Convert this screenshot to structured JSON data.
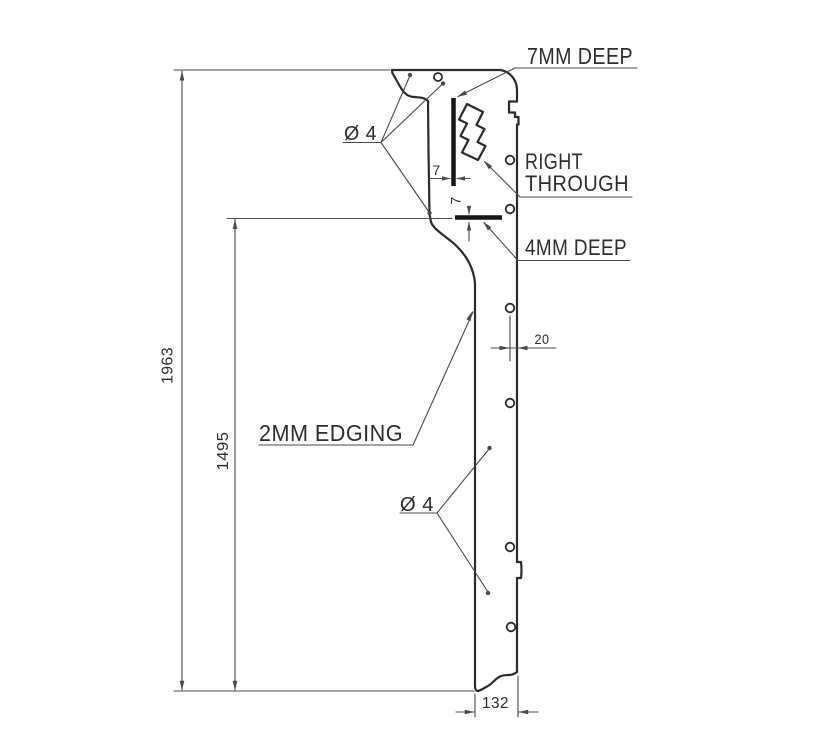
{
  "drawing": {
    "annotations": {
      "top_groove_label": "7MM DEEP",
      "through_label_line1": "RIGHT",
      "through_label_line2": "THROUGH",
      "bottom_groove_label": "4MM DEEP",
      "edging_label": "2MM EDGING",
      "hole_diameter_top": "Ø 4",
      "hole_diameter_bottom": "Ø 4"
    },
    "dimensions": {
      "overall_height": "1963",
      "shoulder_height": "1495",
      "bottom_width": "132",
      "hole_edge_offset": "20",
      "groove_offset_horizontal": "7",
      "groove_offset_vertical": "7"
    },
    "colors": {
      "background": "#ffffff",
      "outline": "#2b2b2b",
      "dimension": "#4a4a4a",
      "groove": "#161616",
      "text": "#2d2d2d"
    }
  }
}
